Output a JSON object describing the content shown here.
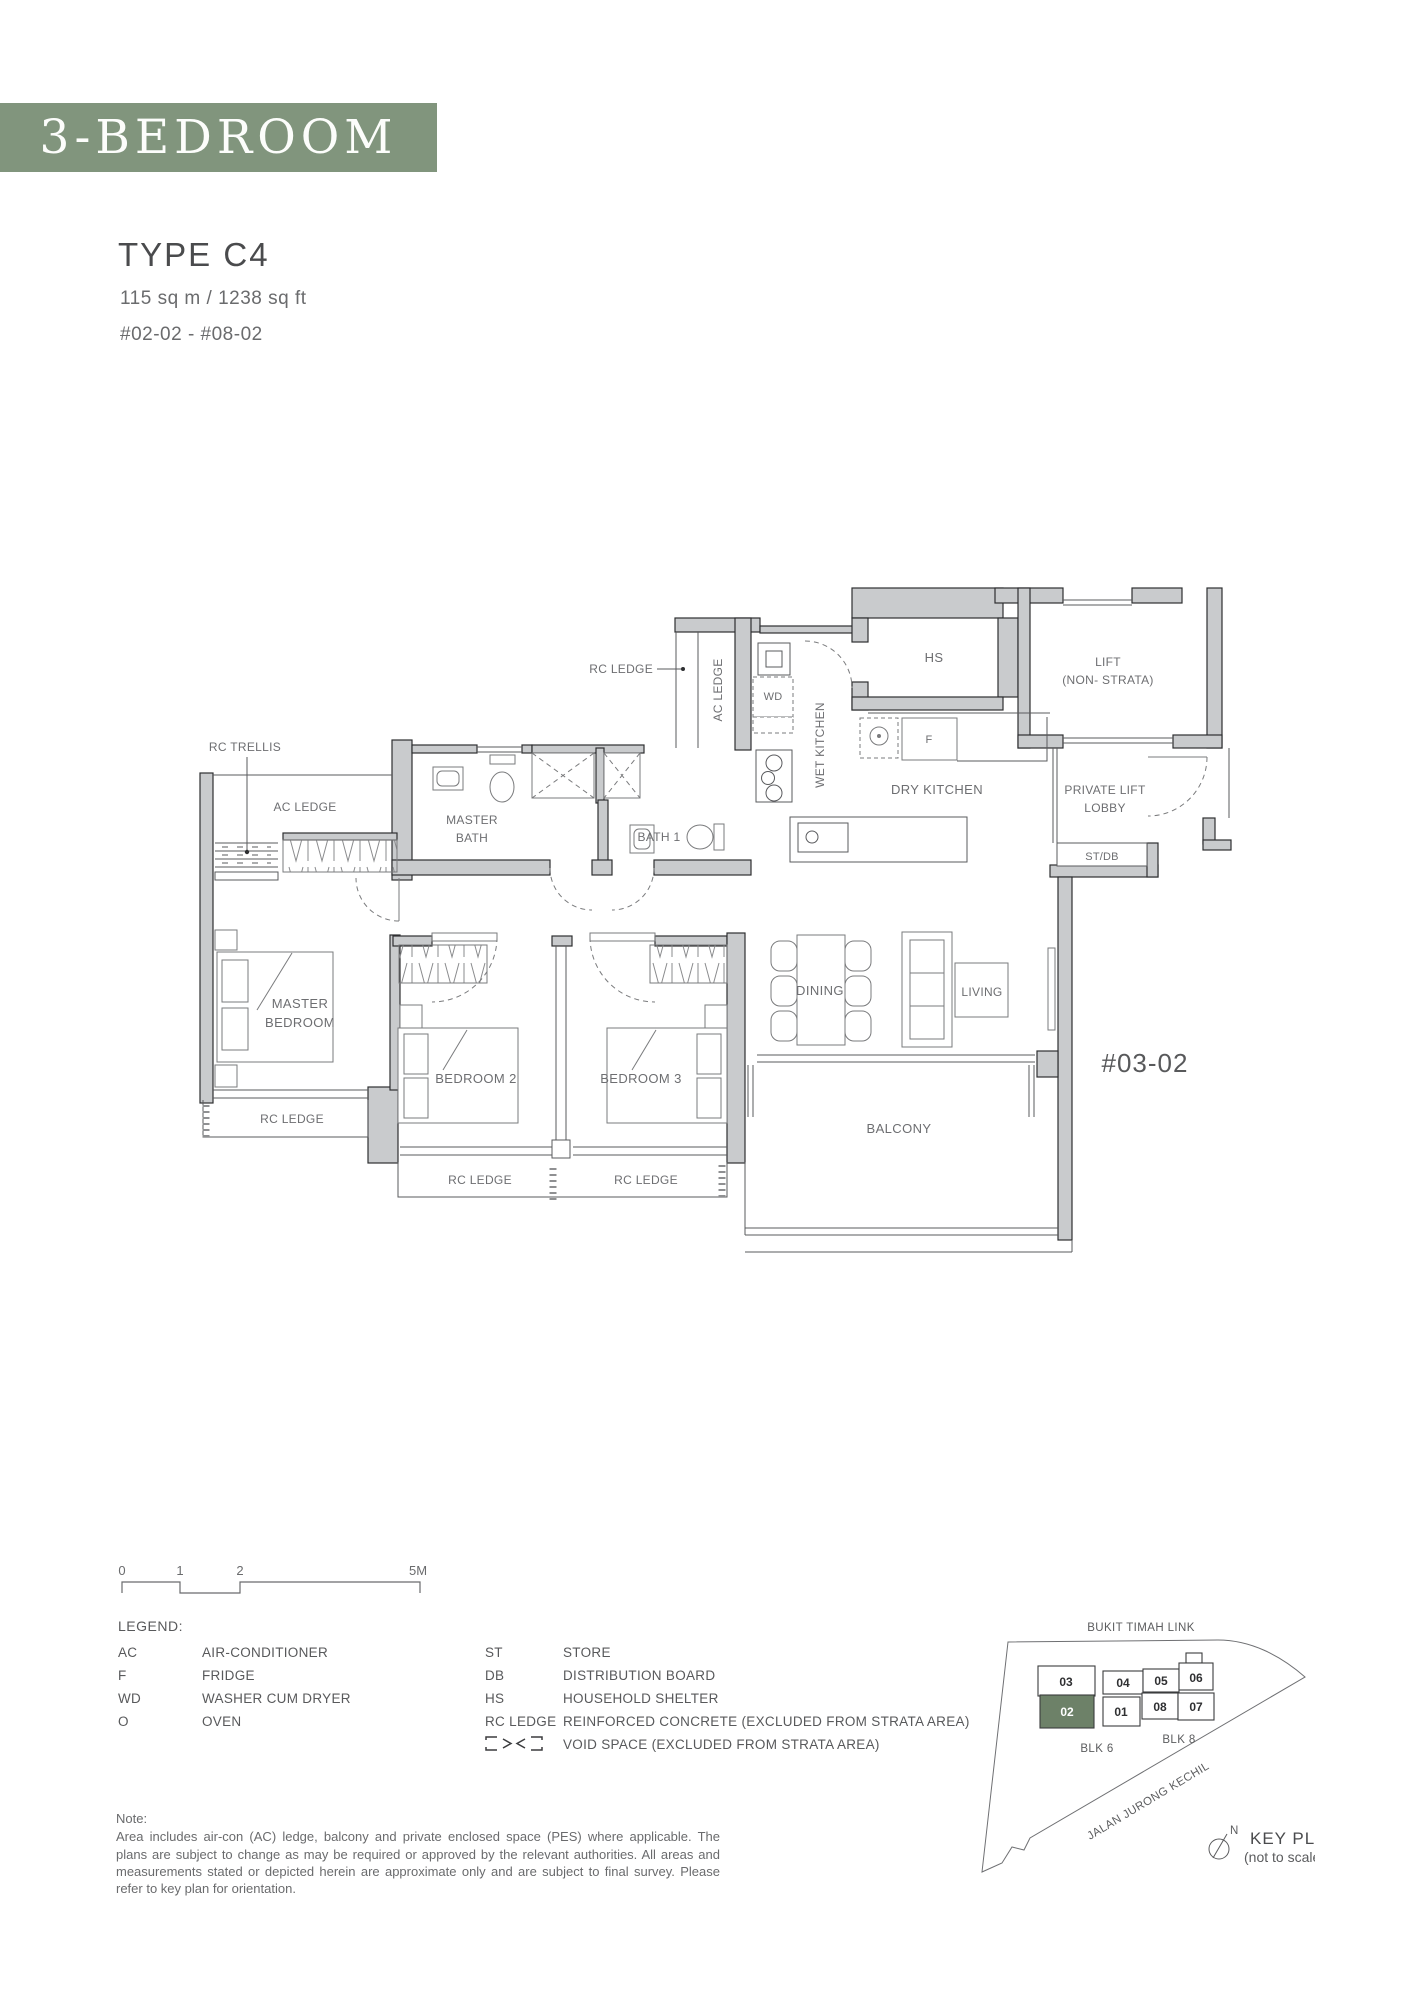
{
  "header": {
    "banner": "3-BEDROOM",
    "type": "TYPE C4",
    "area": "115 sq m / 1238 sq ft",
    "unit_range": "#02-02 - #08-02",
    "banner_color": "#81957d"
  },
  "floorplan": {
    "labels": {
      "rc_ledge_top": "RC LEDGE",
      "ac_ledge_kitchen": "AC LEDGE",
      "wd": "WD",
      "wet_kitchen": "WET KITCHEN",
      "hs": "HS",
      "lift_line1": "LIFT",
      "lift_line2": "(NON- STRATA)",
      "dry_kitchen": "DRY KITCHEN",
      "fridge": "F",
      "private_lift_lobby_line1": "PRIVATE LIFT",
      "private_lift_lobby_line2": "LOBBY",
      "st_db": "ST/DB",
      "rc_trellis": "RC TRELLIS",
      "ac_ledge_master": "AC LEDGE",
      "master_bath_line1": "MASTER",
      "master_bath_line2": "BATH",
      "bath1": "BATH 1",
      "master_bedroom_line1": "MASTER",
      "master_bedroom_line2": "BEDROOM",
      "bedroom2": "BEDROOM 2",
      "bedroom3": "BEDROOM 3",
      "dining": "DINING",
      "living": "LIVING",
      "balcony": "BALCONY",
      "rc_ledge_master": "RC LEDGE",
      "rc_ledge_bedroom2": "RC LEDGE",
      "rc_ledge_bedroom3": "RC LEDGE",
      "stack_unit": "#03-02"
    }
  },
  "scale_bar": {
    "ticks": [
      "0",
      "1",
      "2",
      "5M"
    ]
  },
  "legend": {
    "title": "LEGEND:",
    "col1": [
      {
        "abbr": "AC",
        "desc": "AIR-CONDITIONER"
      },
      {
        "abbr": "F",
        "desc": "FRIDGE"
      },
      {
        "abbr": "WD",
        "desc": "WASHER CUM DRYER"
      },
      {
        "abbr": "O",
        "desc": "OVEN"
      }
    ],
    "col2": [
      {
        "abbr": "ST",
        "desc": "STORE"
      },
      {
        "abbr": "DB",
        "desc": "DISTRIBUTION BOARD"
      },
      {
        "abbr": "HS",
        "desc": "HOUSEHOLD SHELTER"
      },
      {
        "abbr": "RC LEDGE",
        "desc": "REINFORCED CONCRETE (EXCLUDED FROM STRATA AREA)"
      },
      {
        "abbr": "",
        "desc": "VOID SPACE (EXCLUDED FROM STRATA AREA)"
      }
    ]
  },
  "note": {
    "title": "Note:",
    "body": "Area includes air-con (AC) ledge, balcony and private enclosed space (PES) where applicable. The plans are subject to change as may be required or approved by the relevant authorities. All areas and measurements stated or depicted herein are approximate only and are subject to final survey. Please refer to key plan for orientation."
  },
  "key_plan": {
    "title": "KEY PLAN",
    "subtitle": "(not to scale)",
    "north": "N",
    "road_top": "BUKIT TIMAH LINK",
    "road_side": "JALAN JURONG KECHIL",
    "blk6": "BLK 6",
    "blk8": "BLK 8",
    "highlight_color": "#6d8168",
    "units": [
      {
        "no": "03"
      },
      {
        "no": "04"
      },
      {
        "no": "05"
      },
      {
        "no": "06"
      },
      {
        "no": "02",
        "highlighted": true
      },
      {
        "no": "01"
      },
      {
        "no": "08"
      },
      {
        "no": "07"
      }
    ]
  }
}
